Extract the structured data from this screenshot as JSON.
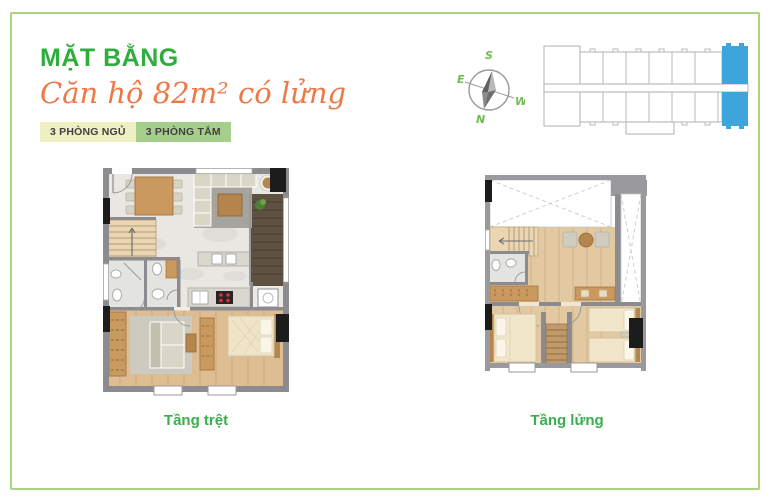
{
  "header": {
    "title": "MẶT BẰNG",
    "subtitle": "Căn hộ 82m² có lửng",
    "badges": [
      {
        "label": "3 PHÒNG NGỦ",
        "bg": "#eef0c3"
      },
      {
        "label": "3 PHÒNG TẮM",
        "bg": "#a6cf8b"
      }
    ]
  },
  "compass": {
    "s": "S",
    "e": "E",
    "w": "W",
    "n": "N"
  },
  "key_plan": {
    "highlighted_unit_color": "#3ea4dc",
    "outline_color": "#b9b9b9"
  },
  "plans": {
    "ground": {
      "caption": "Tầng trệt"
    },
    "mezzanine": {
      "caption": "Tầng lửng"
    }
  },
  "colors": {
    "accent_green": "#2fae3e",
    "caption_green": "#35b14b",
    "accent_orange": "#ef7847",
    "border_green": "#a9d583",
    "highlight_blue": "#3ea4dc",
    "wall_gray": "#8b8b90",
    "wood_floor": "#e0c49c",
    "dark_wood_balcony": "#5f5142",
    "marble_floor": "#e9e7e1"
  }
}
